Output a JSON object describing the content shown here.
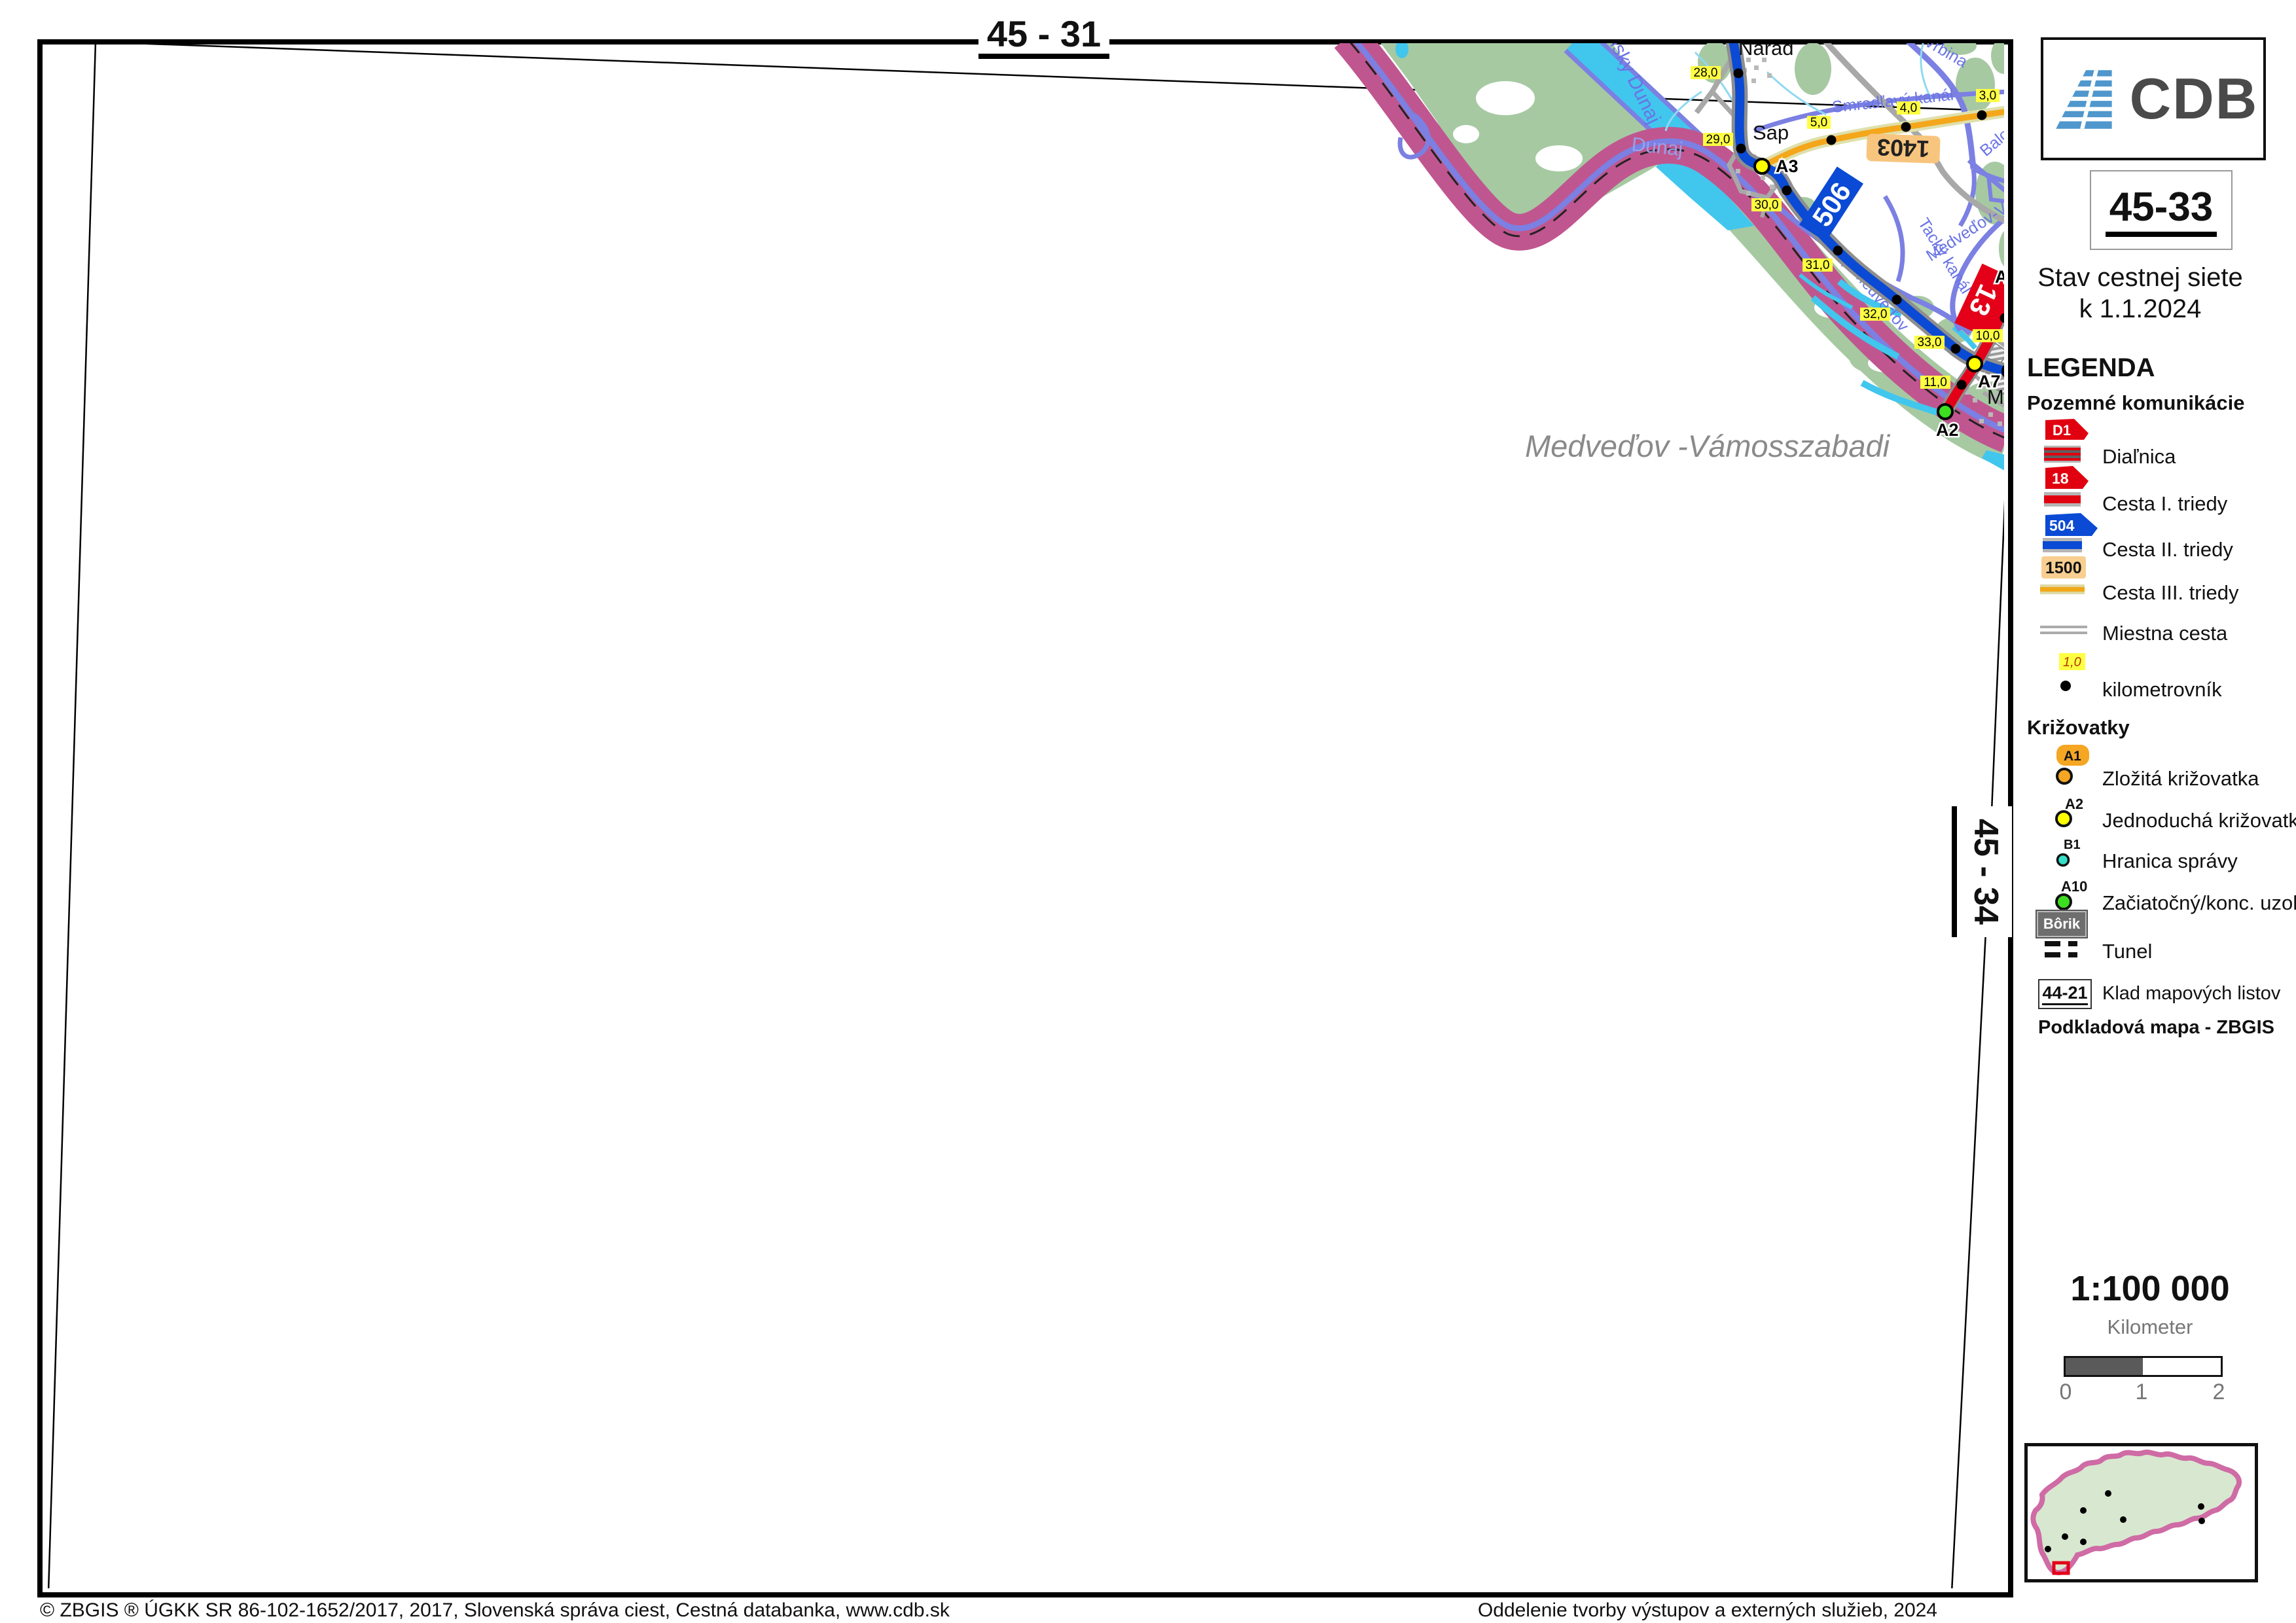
{
  "sheet": {
    "current": "45-33",
    "top_neighbor": "45 - 31",
    "right_neighbor": "45 - 34"
  },
  "header": {
    "logo": "CDB",
    "subtitle_line1": "Stav cestnej siete",
    "subtitle_line2": "k 1.1.2024"
  },
  "legend": {
    "title": "LEGENDA",
    "roads_heading": "Pozemné komunikácie",
    "shield_d1": "D1",
    "shield_18": "18",
    "shield_504": "504",
    "shield_1500": "1500",
    "items": {
      "dialnica": "Diaľnica",
      "cesta1": "Cesta I. triedy",
      "cesta2": "Cesta II. triedy",
      "cesta3": "Cesta III. triedy",
      "miestna": "Miestna cesta",
      "km_value": "1,0",
      "km": "kilometrovník"
    },
    "junctions_heading": "Križovatky",
    "junction_items": {
      "a1": "A1",
      "a1_label": "Zložitá križovatka",
      "a2": "A2",
      "a2_label": "Jednoduchá križovatka",
      "b1": "B1",
      "b1_label": "Hranica správy",
      "a10": "A10",
      "a10_label": "Začiatočný/konc. uzol",
      "tunnel_badge": "Bôrik",
      "tunnel_label": "Tunel"
    },
    "klad_badge": "44-21",
    "klad_label": "Klad mapových listov",
    "base_note": "Podkladová mapa - ZBGIS"
  },
  "scale": {
    "ratio": "1:100 000",
    "unit": "Kilometer",
    "ticks": [
      "0",
      "1",
      "2"
    ]
  },
  "map": {
    "towns": [
      "Nárad",
      "Sap",
      "Me"
    ],
    "corridor_label": "Medveďov -Vámosszabadi",
    "water_labels": [
      "nsky Dunaj",
      "Dunaj",
      "Vrbina",
      "Smradľavý kanál",
      "Balonský ka",
      "Tacký kanál",
      "Sap-Medveďov",
      "Medveďov-Vrb"
    ],
    "km_labels": [
      "28,0",
      "29,0",
      "30,0",
      "31,0",
      "32,0",
      "33,0",
      "5,0",
      "4,0",
      "3,0",
      "10,0",
      "11,0"
    ],
    "junction_labels": [
      "A3",
      "A7",
      "A2",
      "A"
    ],
    "road_shields": {
      "cesta2": "506",
      "cesta3": "1403",
      "cesta1": "13"
    }
  },
  "footer": {
    "left": "© ZBGIS ® ÚGKK SR 86-102-1652/2017, 2017, Slovenská správa ciest, Cestná databanka, www.cdb.sk",
    "right": "Oddelenie tvorby výstupov a externých služieb, 2024"
  },
  "colors": {
    "border_band": "#c0568f",
    "forest_green": "#a6c9a2",
    "water_cyan": "#41c6ee",
    "river_violet": "#7b80e2",
    "road_motorway": "#e30018",
    "road_class2": "#0a4ad4",
    "road_class3": "#f4a71b",
    "km_label_bg": "#ffff42",
    "junction_yellow": "#ffff00",
    "junction_green": "#3ddd1f",
    "junction_orange": "#f5a623",
    "junction_cyan": "#35e0c8"
  }
}
